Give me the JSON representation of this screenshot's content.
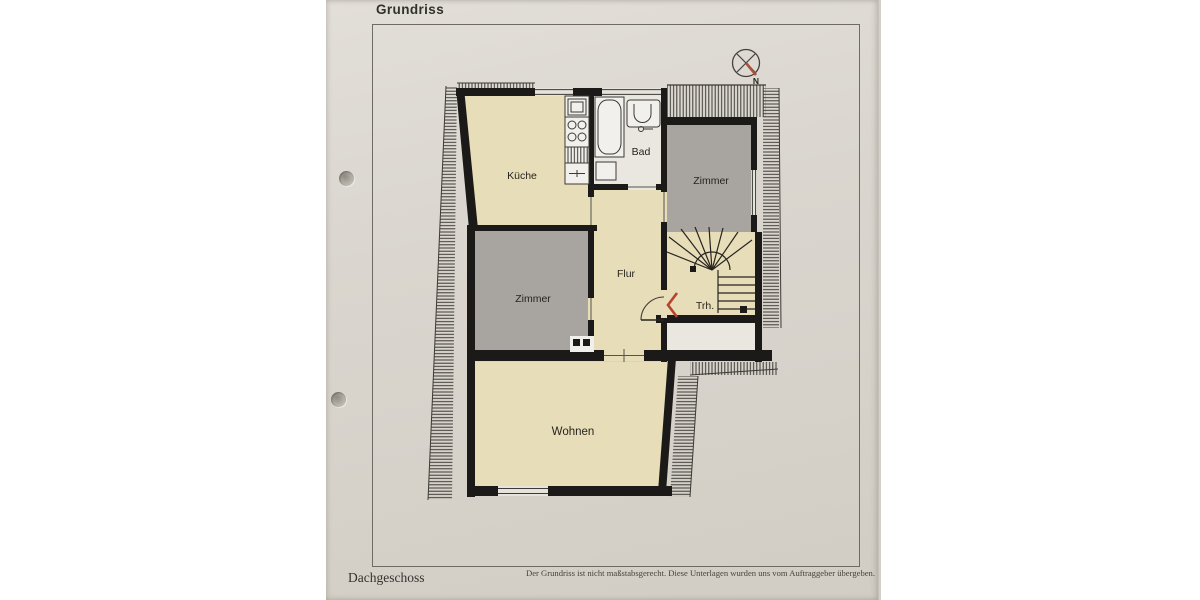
{
  "page": {
    "title": "Grundriss",
    "floor_label": "Dachgeschoss",
    "disclaimer": "Der Grundriss ist nicht maßstabsgerecht. Diese Unterlagen wurden uns vom Auftraggeber übergeben."
  },
  "compass": {
    "label": "N"
  },
  "rooms": {
    "kueche": "Küche",
    "bad": "Bad",
    "zimmer_top": "Zimmer",
    "flur": "Flur",
    "trh": "Trh.",
    "zimmer_left": "Zimmer",
    "wohnen": "Wohnen"
  },
  "colors": {
    "paper": "#d9d5ce",
    "room_beige": "#e8ddb9",
    "room_gray": "#a8a5a0",
    "room_white": "#eae7e1",
    "wall": "#1b1a18",
    "hatch": "#3c3a35",
    "red_accent": "#b5432f"
  }
}
